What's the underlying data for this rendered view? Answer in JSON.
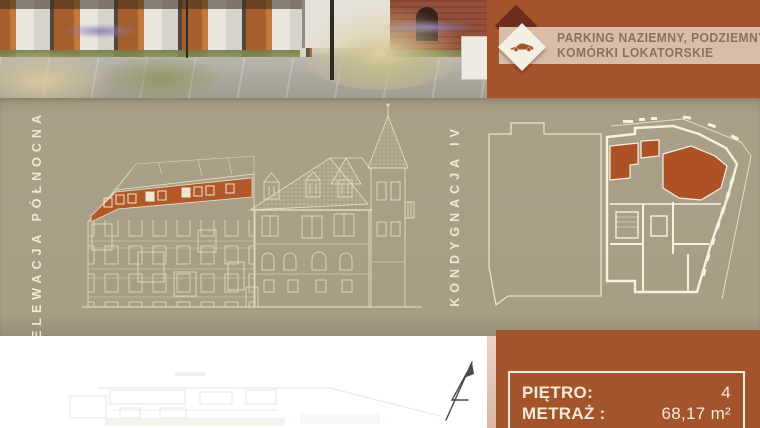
{
  "banner": {
    "line1": "PARKING NAZIEMNY, PODZIEMNY,",
    "line2": "KOMÓRKI LOKATORSKIE"
  },
  "sections": {
    "elevation_label": "ELEWACJA PÓŁNOCNA",
    "floorplan_label": "KONDYGNACJA IV"
  },
  "spec": {
    "floor_label": "PIĘTRO:",
    "floor_value": "4",
    "area_label": "METRAŻ :",
    "area_value": "68,17 m²"
  },
  "icons": {
    "car": "car-icon",
    "diamond_decoration": "diamond-decoration",
    "north_arrow": "north-arrow-icon"
  },
  "colors": {
    "rust": "#a4542a",
    "rust_highlight": "#ad5226",
    "taupe": "#a89e86",
    "cream_line": "#eae2ca",
    "stripe": "#d8bda9",
    "stripe_text": "#8c7162",
    "spec_text": "#f3e9da"
  }
}
